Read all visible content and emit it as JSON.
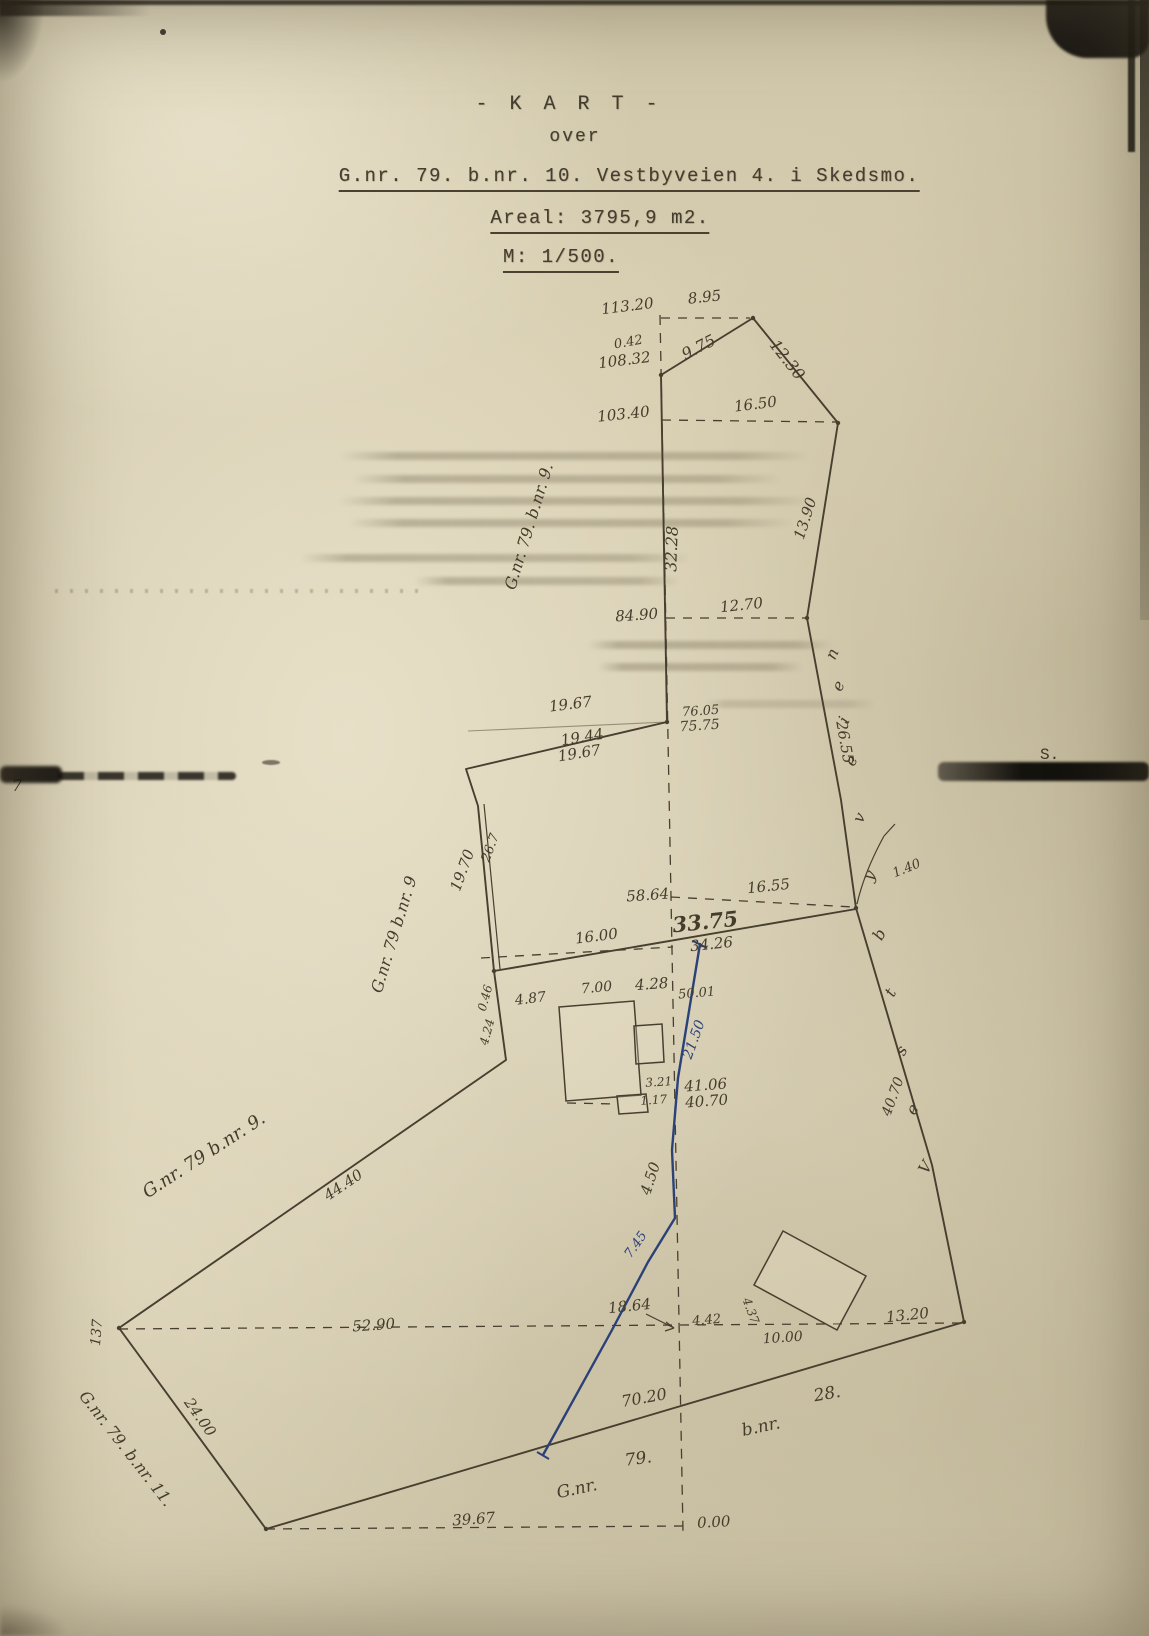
{
  "document": {
    "title": "- K A R T -",
    "subtitle": "over",
    "property_line": "G.nr. 79. b.nr. 10. Vestbyveien 4. i Skedsmo.",
    "area_line": "Areal: 3795,9 m2.",
    "scale_line": "M: 1/500.",
    "edge_note_right": "S.",
    "edge_note_left": "7"
  },
  "map_data": {
    "type": "cadastral-map",
    "ink_color": "#473f2f",
    "blue_color": "#2b4178",
    "baseline": [
      [
        660,
        315
      ],
      [
        683,
        1532
      ]
    ],
    "boundary": [
      [
        661,
        375
      ],
      [
        753,
        318
      ],
      [
        838,
        423
      ],
      [
        807,
        618
      ],
      [
        841,
        800
      ],
      [
        856,
        908
      ],
      [
        932,
        1165
      ],
      [
        964,
        1322
      ],
      [
        266,
        1529
      ],
      [
        119,
        1328
      ],
      [
        506,
        1060
      ],
      [
        494,
        971
      ],
      [
        478,
        806
      ],
      [
        466,
        769
      ],
      [
        667,
        722
      ],
      [
        661,
        375
      ]
    ],
    "double_line": [
      [
        484,
        804
      ],
      [
        500,
        969
      ]
    ],
    "solid_lines": [
      [
        [
          494,
          971
        ],
        [
          856,
          909
        ]
      ]
    ],
    "faint_lines": [
      [
        [
          468,
          731
        ],
        [
          667,
          722
        ]
      ]
    ],
    "dashed_ties": [
      [
        [
          661,
          318
        ],
        [
          750,
          318
        ]
      ],
      [
        [
          662,
          420
        ],
        [
          836,
          422
        ]
      ],
      [
        [
          666,
          618
        ],
        [
          805,
          618
        ]
      ],
      [
        [
          671,
          897
        ],
        [
          853,
          907
        ]
      ],
      [
        [
          481,
          958
        ],
        [
          673,
          947
        ]
      ],
      [
        [
          119,
          1329
        ],
        [
          963,
          1323
        ]
      ],
      [
        [
          266,
          1529
        ],
        [
          684,
          1526
        ]
      ],
      [
        [
          567,
          1103
        ],
        [
          618,
          1104
        ]
      ]
    ],
    "thin_lines": [
      [
        [
          646,
          1314
        ],
        [
          674,
          1328
        ]
      ],
      [
        [
          674,
          1328
        ],
        [
          666,
          1322
        ]
      ],
      [
        [
          674,
          1328
        ],
        [
          665,
          1331
        ]
      ],
      [
        [
          884,
          836
        ],
        [
          895,
          824
        ]
      ]
    ],
    "arc_path": "M884,836 C872,858 862,882 857,904",
    "blue_line": [
      [
        700,
        944
      ],
      [
        678,
        1078
      ],
      [
        672,
        1150
      ],
      [
        675,
        1218
      ],
      [
        648,
        1262
      ],
      [
        612,
        1330
      ],
      [
        553,
        1437
      ],
      [
        543,
        1455
      ]
    ],
    "blue_ticks": [
      [
        [
          693,
          941
        ],
        [
          707,
          948
        ]
      ],
      [
        [
          537,
          1452
        ],
        [
          549,
          1459
        ]
      ]
    ],
    "corner_dots": [
      [
        661,
        375
      ],
      [
        753,
        318
      ],
      [
        838,
        423
      ],
      [
        807,
        618
      ],
      [
        856,
        908
      ],
      [
        964,
        1322
      ],
      [
        266,
        1529
      ],
      [
        119,
        1328
      ],
      [
        494,
        971
      ],
      [
        667,
        722
      ]
    ],
    "buildings": [
      {
        "pts": [
          [
            559,
            1007
          ],
          [
            634,
            1001
          ],
          [
            641,
            1095
          ],
          [
            566,
            1101
          ]
        ]
      },
      {
        "pts": [
          [
            634,
            1026
          ],
          [
            662,
            1024
          ],
          [
            664,
            1062
          ],
          [
            636,
            1064
          ]
        ]
      },
      {
        "pts": [
          [
            617,
            1096
          ],
          [
            646,
            1094
          ],
          [
            648,
            1112
          ],
          [
            619,
            1114
          ]
        ]
      },
      {
        "pts": [
          [
            783,
            1231
          ],
          [
            866,
            1276
          ],
          [
            837,
            1330
          ],
          [
            754,
            1285
          ]
        ]
      }
    ],
    "labels": [
      {
        "t": "113.20",
        "x": 628,
        "y": 311,
        "r": -7
      },
      {
        "t": "8.95",
        "x": 705,
        "y": 302,
        "r": -6
      },
      {
        "t": "0.42",
        "x": 629,
        "y": 346,
        "r": -10,
        "s": 13
      },
      {
        "t": "108.32",
        "x": 625,
        "y": 365,
        "r": -7
      },
      {
        "t": "9.75",
        "x": 701,
        "y": 352,
        "r": -27,
        "s": 16
      },
      {
        "t": "12.30",
        "x": 783,
        "y": 363,
        "r": 52,
        "s": 16
      },
      {
        "t": "103.40",
        "x": 624,
        "y": 419,
        "r": -6
      },
      {
        "t": "16.50",
        "x": 756,
        "y": 409,
        "r": -7
      },
      {
        "t": "32.28",
        "x": 677,
        "y": 549,
        "r": -88,
        "s": 16
      },
      {
        "t": "13.90",
        "x": 810,
        "y": 520,
        "r": -72
      },
      {
        "t": "84.90",
        "x": 637,
        "y": 620,
        "r": -4
      },
      {
        "t": "12.70",
        "x": 742,
        "y": 610,
        "r": -6
      },
      {
        "t": "19.67",
        "x": 571,
        "y": 709,
        "r": -7
      },
      {
        "t": "76.05",
        "x": 701,
        "y": 715,
        "r": -4,
        "s": 13
      },
      {
        "t": "75.75",
        "x": 700,
        "y": 730,
        "r": -4,
        "s": 14
      },
      {
        "t": "19.44",
        "x": 583,
        "y": 742,
        "r": -9
      },
      {
        "t": "19.67",
        "x": 580,
        "y": 758,
        "r": -9
      },
      {
        "t": "26.55",
        "x": 840,
        "y": 743,
        "r": 80,
        "s": 15
      },
      {
        "t": "G.nr. 79. b.nr. 9.",
        "x": 534,
        "y": 528,
        "r": -73,
        "s": 16
      },
      {
        "t": "G.nr. 79 b.nr. 9",
        "x": 399,
        "y": 936,
        "r": -73,
        "s": 16
      },
      {
        "t": "19.70",
        "x": 467,
        "y": 872,
        "r": -70
      },
      {
        "t": "26.7",
        "x": 494,
        "y": 849,
        "r": -70,
        "s": 13
      },
      {
        "t": "58.64",
        "x": 648,
        "y": 900,
        "r": -4
      },
      {
        "t": "16.55",
        "x": 769,
        "y": 891,
        "r": -6
      },
      {
        "t": "1.40",
        "x": 908,
        "y": 872,
        "r": -22,
        "s": 13
      },
      {
        "t": "33.75",
        "x": 706,
        "y": 929,
        "r": -6,
        "s": 21,
        "w": 1
      },
      {
        "t": "34.26",
        "x": 712,
        "y": 949,
        "r": -6
      },
      {
        "t": "16.00",
        "x": 597,
        "y": 941,
        "r": -7
      },
      {
        "t": "0.46",
        "x": 489,
        "y": 999,
        "r": -75,
        "s": 12
      },
      {
        "t": "4.24",
        "x": 491,
        "y": 1033,
        "r": -75,
        "s": 12
      },
      {
        "t": "4.87",
        "x": 531,
        "y": 1003,
        "r": -7,
        "s": 14
      },
      {
        "t": "7.00",
        "x": 597,
        "y": 992,
        "r": -5,
        "s": 14
      },
      {
        "t": "4.28",
        "x": 652,
        "y": 989,
        "r": -4
      },
      {
        "t": "50.01",
        "x": 697,
        "y": 997,
        "r": -5,
        "s": 13
      },
      {
        "t": "21.50",
        "x": 698,
        "y": 1041,
        "r": -70,
        "s": 14,
        "c": "#2b4178"
      },
      {
        "t": "3.21",
        "x": 659,
        "y": 1086,
        "r": -4,
        "s": 12
      },
      {
        "t": "41.06",
        "x": 706,
        "y": 1090,
        "r": -4
      },
      {
        "t": "1.17",
        "x": 654,
        "y": 1104,
        "r": -4,
        "s": 12
      },
      {
        "t": "40.70",
        "x": 707,
        "y": 1106,
        "r": -4
      },
      {
        "t": "4.50",
        "x": 655,
        "y": 1180,
        "r": -72
      },
      {
        "t": "G.nr. 79 b.nr. 9.",
        "x": 207,
        "y": 1160,
        "r": -33,
        "s": 18
      },
      {
        "t": "44.40",
        "x": 346,
        "y": 1189,
        "r": -34
      },
      {
        "t": "7.45",
        "x": 639,
        "y": 1247,
        "r": -55,
        "s": 13,
        "c": "#2b4178"
      },
      {
        "t": "18.64",
        "x": 630,
        "y": 1311,
        "r": -6
      },
      {
        "t": "52.90",
        "x": 374,
        "y": 1330,
        "r": -4
      },
      {
        "t": "4.42",
        "x": 707,
        "y": 1324,
        "r": -5,
        "s": 13
      },
      {
        "t": "4.37",
        "x": 747,
        "y": 1312,
        "r": 70,
        "s": 12
      },
      {
        "t": "10.00",
        "x": 783,
        "y": 1342,
        "r": -4,
        "s": 14
      },
      {
        "t": "13.20",
        "x": 908,
        "y": 1320,
        "r": -6
      },
      {
        "t": "40.70",
        "x": 897,
        "y": 1098,
        "r": -70,
        "s": 14
      },
      {
        "t": "137",
        "x": 101,
        "y": 1333,
        "r": -85,
        "s": 14
      },
      {
        "t": "24.00",
        "x": 196,
        "y": 1420,
        "r": 55
      },
      {
        "t": "G.nr. 79. b.nr. 11.",
        "x": 122,
        "y": 1452,
        "r": 52,
        "s": 16
      },
      {
        "t": "70.20",
        "x": 645,
        "y": 1403,
        "r": -10,
        "s": 16
      },
      {
        "t": "b.nr.",
        "x": 762,
        "y": 1432,
        "r": -12,
        "s": 17
      },
      {
        "t": "28.",
        "x": 828,
        "y": 1399,
        "r": -10,
        "s": 17
      },
      {
        "t": "G.nr.",
        "x": 578,
        "y": 1494,
        "r": -12,
        "s": 17
      },
      {
        "t": "79.",
        "x": 639,
        "y": 1464,
        "r": -8,
        "s": 17
      },
      {
        "t": "39.67",
        "x": 474,
        "y": 1524,
        "r": -4
      },
      {
        "t": "0.00",
        "x": 714,
        "y": 1527,
        "r": -3
      },
      {
        "t": "V",
        "x": 930,
        "y": 1170,
        "r": -60,
        "s": 16
      },
      {
        "t": "e",
        "x": 917,
        "y": 1112,
        "r": -60,
        "s": 16
      },
      {
        "t": "s",
        "x": 906,
        "y": 1053,
        "r": -61,
        "s": 16
      },
      {
        "t": "t",
        "x": 895,
        "y": 995,
        "r": -61,
        "s": 16
      },
      {
        "t": "b",
        "x": 884,
        "y": 937,
        "r": -62,
        "s": 16
      },
      {
        "t": "y",
        "x": 874,
        "y": 878,
        "r": -63,
        "s": 16
      },
      {
        "t": "v",
        "x": 864,
        "y": 820,
        "r": -64,
        "s": 16
      },
      {
        "t": "e",
        "x": 856,
        "y": 763,
        "r": -65,
        "s": 16
      },
      {
        "t": "i",
        "x": 849,
        "y": 722,
        "r": -66,
        "s": 16
      },
      {
        "t": "e",
        "x": 843,
        "y": 688,
        "r": -66,
        "s": 16
      },
      {
        "t": "n",
        "x": 837,
        "y": 656,
        "r": -66,
        "s": 16
      }
    ]
  }
}
